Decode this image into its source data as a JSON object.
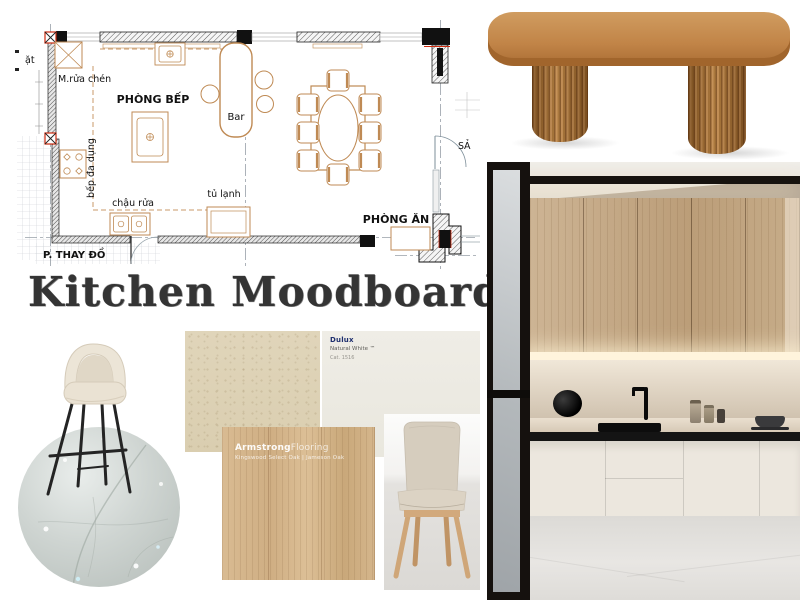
{
  "title": {
    "text": "Kitchen Moodboard",
    "color": "#343434"
  },
  "floor_plan": {
    "labels": {
      "laundry_clipped": "ặt",
      "dishwasher": "M.rửa chén",
      "kitchen_room": "PHÒNG BẾP",
      "bar": "Bar",
      "stove": "bếp đa dụng",
      "sink": "chậu rửa",
      "fridge": "tủ lạnh",
      "dining_room": "PHÒNG ĂN",
      "changing_room": "P. THAY ĐỒ",
      "hall_clipped": "SẢ"
    },
    "colors": {
      "furniture_line": "#bf8a54",
      "wall_line": "#1c1c1c",
      "marker_red": "#cc2a0e",
      "centerline_gray": "#98a0a8"
    }
  },
  "materials": {
    "paint_chip_left": {
      "color": "#ddd2b5"
    },
    "paint_chip_right": {
      "brand": "Dulux",
      "name_line": "Natural White ™",
      "code_line": "Cat. 1516",
      "color": "#edebe2"
    },
    "flooring_sample": {
      "brand_bold": "Armstrong",
      "brand_light": "Flooring",
      "caption": "Kingswood Select Oak | Jameson Oak",
      "wood_color": "#d3b288"
    },
    "marble_sample": {
      "color": "#c9cfcc"
    }
  },
  "furniture": {
    "dining_table": {
      "wood_color": "#bc8147"
    },
    "bar_stool": {
      "fabric_color": "#ebe4d6",
      "leg_color": "#262626"
    },
    "dining_chair": {
      "fabric_color": "#d5ccbd",
      "leg_color": "#cda371"
    }
  },
  "kitchen_photo": {
    "cabinet_wood": "#c4ab8a",
    "base_cabinet": "#eae5dc",
    "counter_edge": "#151515",
    "wall": "#c2b5a6"
  }
}
